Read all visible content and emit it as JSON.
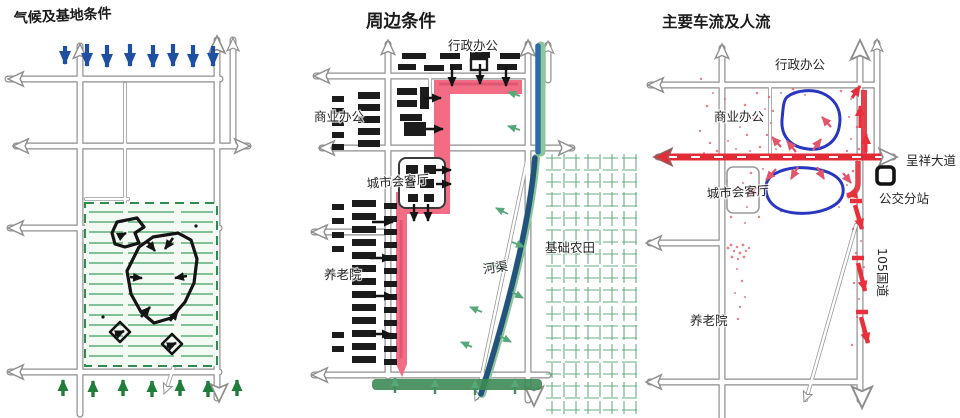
{
  "page": {
    "background": "#ffffff"
  },
  "colors": {
    "wind_arrow_blue": "#1e4fa3",
    "vegetation_green": "#1f7c39",
    "site_hatch_green": "#5cae79",
    "road_gray": "#8e8e8e",
    "sketch_black": "#141414",
    "highlight_pink": "#f26d84",
    "traffic_red": "#e32b36",
    "flow_dot_red": "#e25663",
    "loop_blue": "#2836c0",
    "river_blue": "#24527e",
    "farmland_green": "#4e9d6d"
  },
  "panels": {
    "climate": {
      "title": "气候及基地条件"
    },
    "surroundings": {
      "title": "周边条件",
      "labels": {
        "admin_office": "行政办公",
        "commercial_office": "商业办公",
        "city_living_room": "城市会客厅",
        "nursing_home": "养老院",
        "river": "河渠",
        "farmland": "基础农田"
      }
    },
    "traffic": {
      "title": "主要车流及人流",
      "labels": {
        "admin_office": "行政办公",
        "commercial_office": "商业办公",
        "city_living_room": "城市会客厅",
        "nursing_home": "养老院",
        "avenue": "呈祥大道",
        "bus_substation": "公交分站",
        "national_highway": "105国道"
      }
    }
  }
}
